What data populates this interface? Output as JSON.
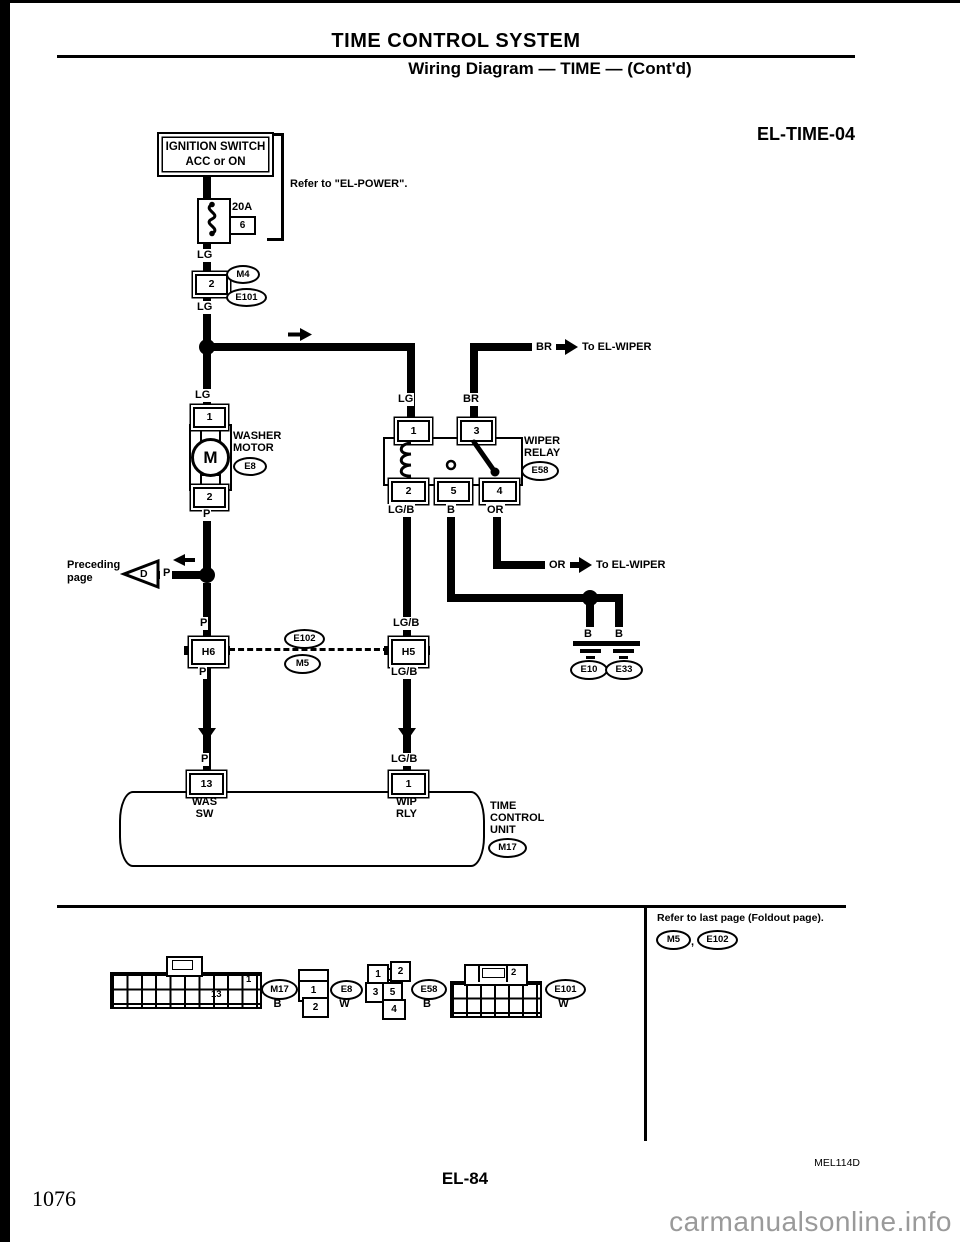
{
  "page": {
    "section_title": "TIME CONTROL SYSTEM",
    "subtitle": "Wiring Diagram — TIME — (Cont'd)",
    "diagram_code": "EL-TIME-04",
    "figure_code": "MEL114D",
    "page_number": "EL-84",
    "book_page": "1076",
    "watermark": "carmanualsonline.info"
  },
  "power_feed": {
    "ignition_line1": "IGNITION SWITCH",
    "ignition_line2": "ACC or ON",
    "refer_note": "Refer to \"EL-POWER\".",
    "fuse_rating": "20A",
    "fuse_box": "6",
    "wire_lg1": "LG",
    "pin": "2",
    "conn_m4": "M4",
    "conn_e101": "E101",
    "wire_lg2": "LG",
    "wire_lg3": "LG"
  },
  "branch_br": {
    "wire": "BR",
    "dest": "To EL-WIPER"
  },
  "washer_motor": {
    "wire_top": "LG",
    "pin_top": "1",
    "letter": "M",
    "name1": "WASHER",
    "name2": "MOTOR",
    "conn": "E8",
    "pin_bottom": "2",
    "wire_bottom": "P"
  },
  "wiper_relay": {
    "wire1": "LG",
    "wire3": "BR",
    "pin1": "1",
    "pin3": "3",
    "name1": "WIPER",
    "name2": "RELAY",
    "conn": "E58",
    "pin2": "2",
    "pin5": "5",
    "pin4": "4",
    "wire2": "LG/B",
    "wire5": "B",
    "wire4": "OR"
  },
  "branch_or": {
    "wire": "OR",
    "dest": "To EL-WIPER"
  },
  "preceding": {
    "line1": "Preceding",
    "line2": "page",
    "letter": "D",
    "wire": "P"
  },
  "splice": {
    "wire_left_above": "P",
    "conn_left": "H6",
    "wire_left_below": "P",
    "wire_right_above": "LG/B",
    "conn_right": "H5",
    "wire_right_below": "LG/B",
    "conn_e102": "E102",
    "conn_m5": "M5"
  },
  "grounds": {
    "wire_left": "B",
    "wire_right": "B",
    "conn_left": "E10",
    "conn_right": "E33"
  },
  "control_unit": {
    "wire_left": "P",
    "pin_left": "13",
    "pin_left_name1": "WAS",
    "pin_left_name2": "SW",
    "wire_right": "LG/B",
    "pin_right": "1",
    "pin_right_name1": "WIP",
    "pin_right_name2": "RLY",
    "name1": "TIME",
    "name2": "CONTROL",
    "name3": "UNIT",
    "conn": "M17"
  },
  "footer_note": {
    "text": "Refer to last page (Foldout page).",
    "conn1": "M5",
    "separator": ",",
    "conn2": "E102"
  },
  "connector_views": {
    "m17": {
      "pin_a": "1",
      "pin_b": "13",
      "id": "M17",
      "color": "B"
    },
    "e8": {
      "pin_a": "1",
      "pin_b": "2",
      "id": "E8",
      "color": "W"
    },
    "e58": {
      "p1": "1",
      "p2": "2",
      "p3": "3",
      "p5": "5",
      "p4": "4",
      "id": "E58",
      "color": "B"
    },
    "e101": {
      "pin": "2",
      "id": "E101",
      "color": "W"
    }
  }
}
